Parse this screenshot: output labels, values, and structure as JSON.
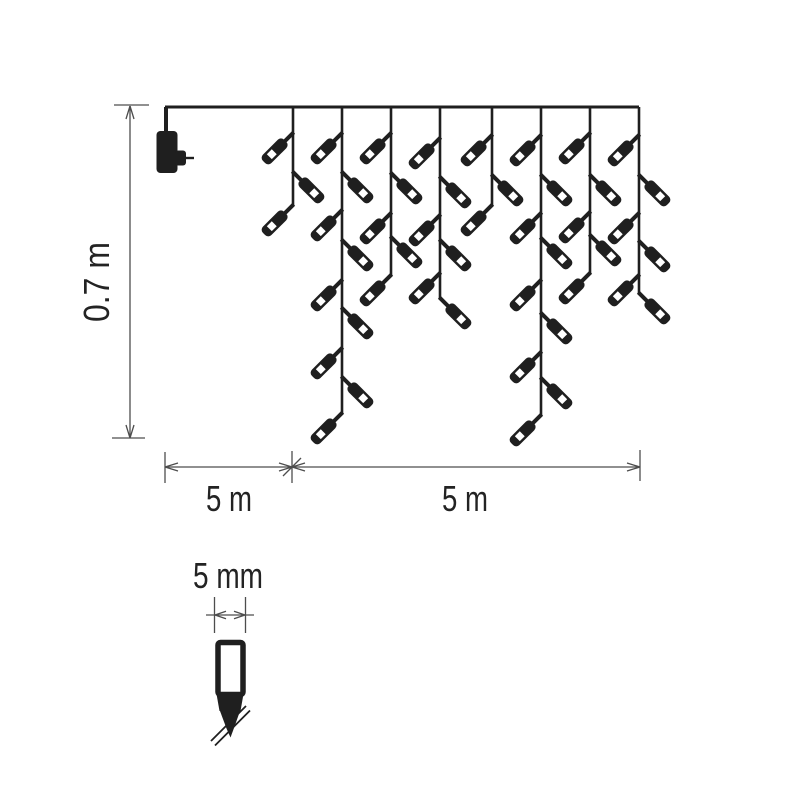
{
  "diagram": {
    "title": "icicle-light-string-dimension-diagram",
    "labels": {
      "height": "0.7 m",
      "lead_length": "5 m",
      "lit_length": "5 m",
      "bulb_diameter": "5 mm"
    },
    "colors": {
      "ink": "#1f1f1f",
      "dim_line": "#4d4d4d",
      "text": "#232323",
      "bg": "#ffffff"
    },
    "wire": {
      "x1": 165,
      "x2": 639,
      "y": 107
    },
    "drops": [
      {
        "x": 293,
        "end": 205,
        "bulbs": [
          {
            "y": 133,
            "side": "left"
          },
          {
            "y": 172,
            "side": "right"
          },
          {
            "y": 205,
            "side": "left"
          }
        ]
      },
      {
        "x": 342,
        "end": 413,
        "bulbs": [
          {
            "y": 133,
            "side": "left"
          },
          {
            "y": 172,
            "side": "right"
          },
          {
            "y": 210,
            "side": "left"
          },
          {
            "y": 240,
            "side": "right"
          },
          {
            "y": 280,
            "side": "left"
          },
          {
            "y": 308,
            "side": "right"
          },
          {
            "y": 348,
            "side": "left"
          },
          {
            "y": 377,
            "side": "right"
          },
          {
            "y": 413,
            "side": "left"
          }
        ]
      },
      {
        "x": 391,
        "end": 275,
        "bulbs": [
          {
            "y": 133,
            "side": "left"
          },
          {
            "y": 173,
            "side": "right"
          },
          {
            "y": 213,
            "side": "left"
          },
          {
            "y": 237,
            "side": "right"
          },
          {
            "y": 275,
            "side": "left"
          }
        ]
      },
      {
        "x": 440,
        "end": 298,
        "bulbs": [
          {
            "y": 138,
            "side": "left"
          },
          {
            "y": 177,
            "side": "right"
          },
          {
            "y": 215,
            "side": "left"
          },
          {
            "y": 240,
            "side": "right"
          },
          {
            "y": 273,
            "side": "left"
          },
          {
            "y": 298,
            "side": "right"
          }
        ]
      },
      {
        "x": 492,
        "end": 205,
        "bulbs": [
          {
            "y": 135,
            "side": "left"
          },
          {
            "y": 175,
            "side": "right"
          },
          {
            "y": 205,
            "side": "left"
          }
        ]
      },
      {
        "x": 541,
        "end": 415,
        "bulbs": [
          {
            "y": 135,
            "side": "left"
          },
          {
            "y": 175,
            "side": "right"
          },
          {
            "y": 213,
            "side": "left"
          },
          {
            "y": 238,
            "side": "right"
          },
          {
            "y": 280,
            "side": "left"
          },
          {
            "y": 313,
            "side": "right"
          },
          {
            "y": 352,
            "side": "left"
          },
          {
            "y": 378,
            "side": "right"
          },
          {
            "y": 415,
            "side": "left"
          }
        ]
      },
      {
        "x": 590,
        "end": 273,
        "bulbs": [
          {
            "y": 133,
            "side": "left"
          },
          {
            "y": 175,
            "side": "right"
          },
          {
            "y": 212,
            "side": "left"
          },
          {
            "y": 235,
            "side": "right"
          },
          {
            "y": 273,
            "side": "left"
          }
        ]
      },
      {
        "x": 639,
        "end": 293,
        "bulbs": [
          {
            "y": 135,
            "side": "left"
          },
          {
            "y": 175,
            "side": "right"
          },
          {
            "y": 213,
            "side": "left"
          },
          {
            "y": 241,
            "side": "right"
          },
          {
            "y": 275,
            "side": "left"
          },
          {
            "y": 293,
            "side": "right"
          }
        ]
      }
    ]
  }
}
